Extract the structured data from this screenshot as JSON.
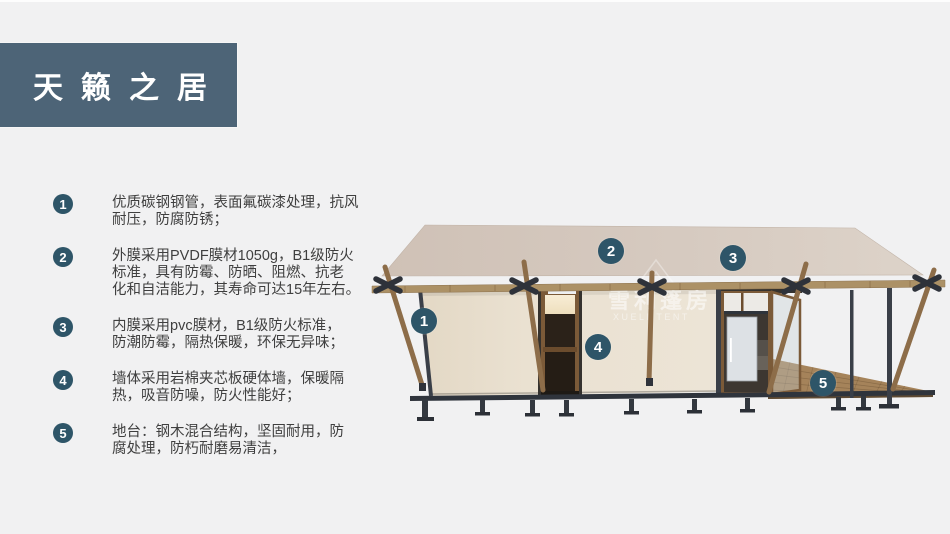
{
  "header": {
    "title": "天籁之居"
  },
  "specs": {
    "items": [
      {
        "num": "1",
        "text": "优质碳钢钢管，表面氟碳漆处理，抗风\n耐压，防腐防锈；"
      },
      {
        "num": "2",
        "text": "外膜采用PVDF膜材1050g，B1级防火\n标准，具有防霉、防晒、阻燃、抗老\n化和自洁能力，其寿命可达15年左右。"
      },
      {
        "num": "3",
        "text": "内膜采用pvc膜材，B1级防火标准，\n防潮防霉，隔热保暖，环保无异味；"
      },
      {
        "num": "4",
        "text": "墙体采用岩棉夹芯板硬体墙，保暖隔\n热，吸音防噪，防火性能好；"
      },
      {
        "num": "5",
        "text": "地台：钢木混合结构，坚固耐用，防\n腐处理，防朽耐磨易清洁，"
      }
    ]
  },
  "diagram": {
    "markers": [
      {
        "label": "1"
      },
      {
        "label": "2"
      },
      {
        "label": "3"
      },
      {
        "label": "4"
      },
      {
        "label": "5"
      }
    ],
    "watermark": {
      "cn": "雪利篷房",
      "en": "XUELI TENT"
    }
  },
  "colors": {
    "accent_badge": "#2e5568",
    "header_bg": "#4d6477",
    "roof": "#d5c9be",
    "wall": "#eae1d1",
    "wood": "#8d6d49",
    "metal": "#343944"
  }
}
